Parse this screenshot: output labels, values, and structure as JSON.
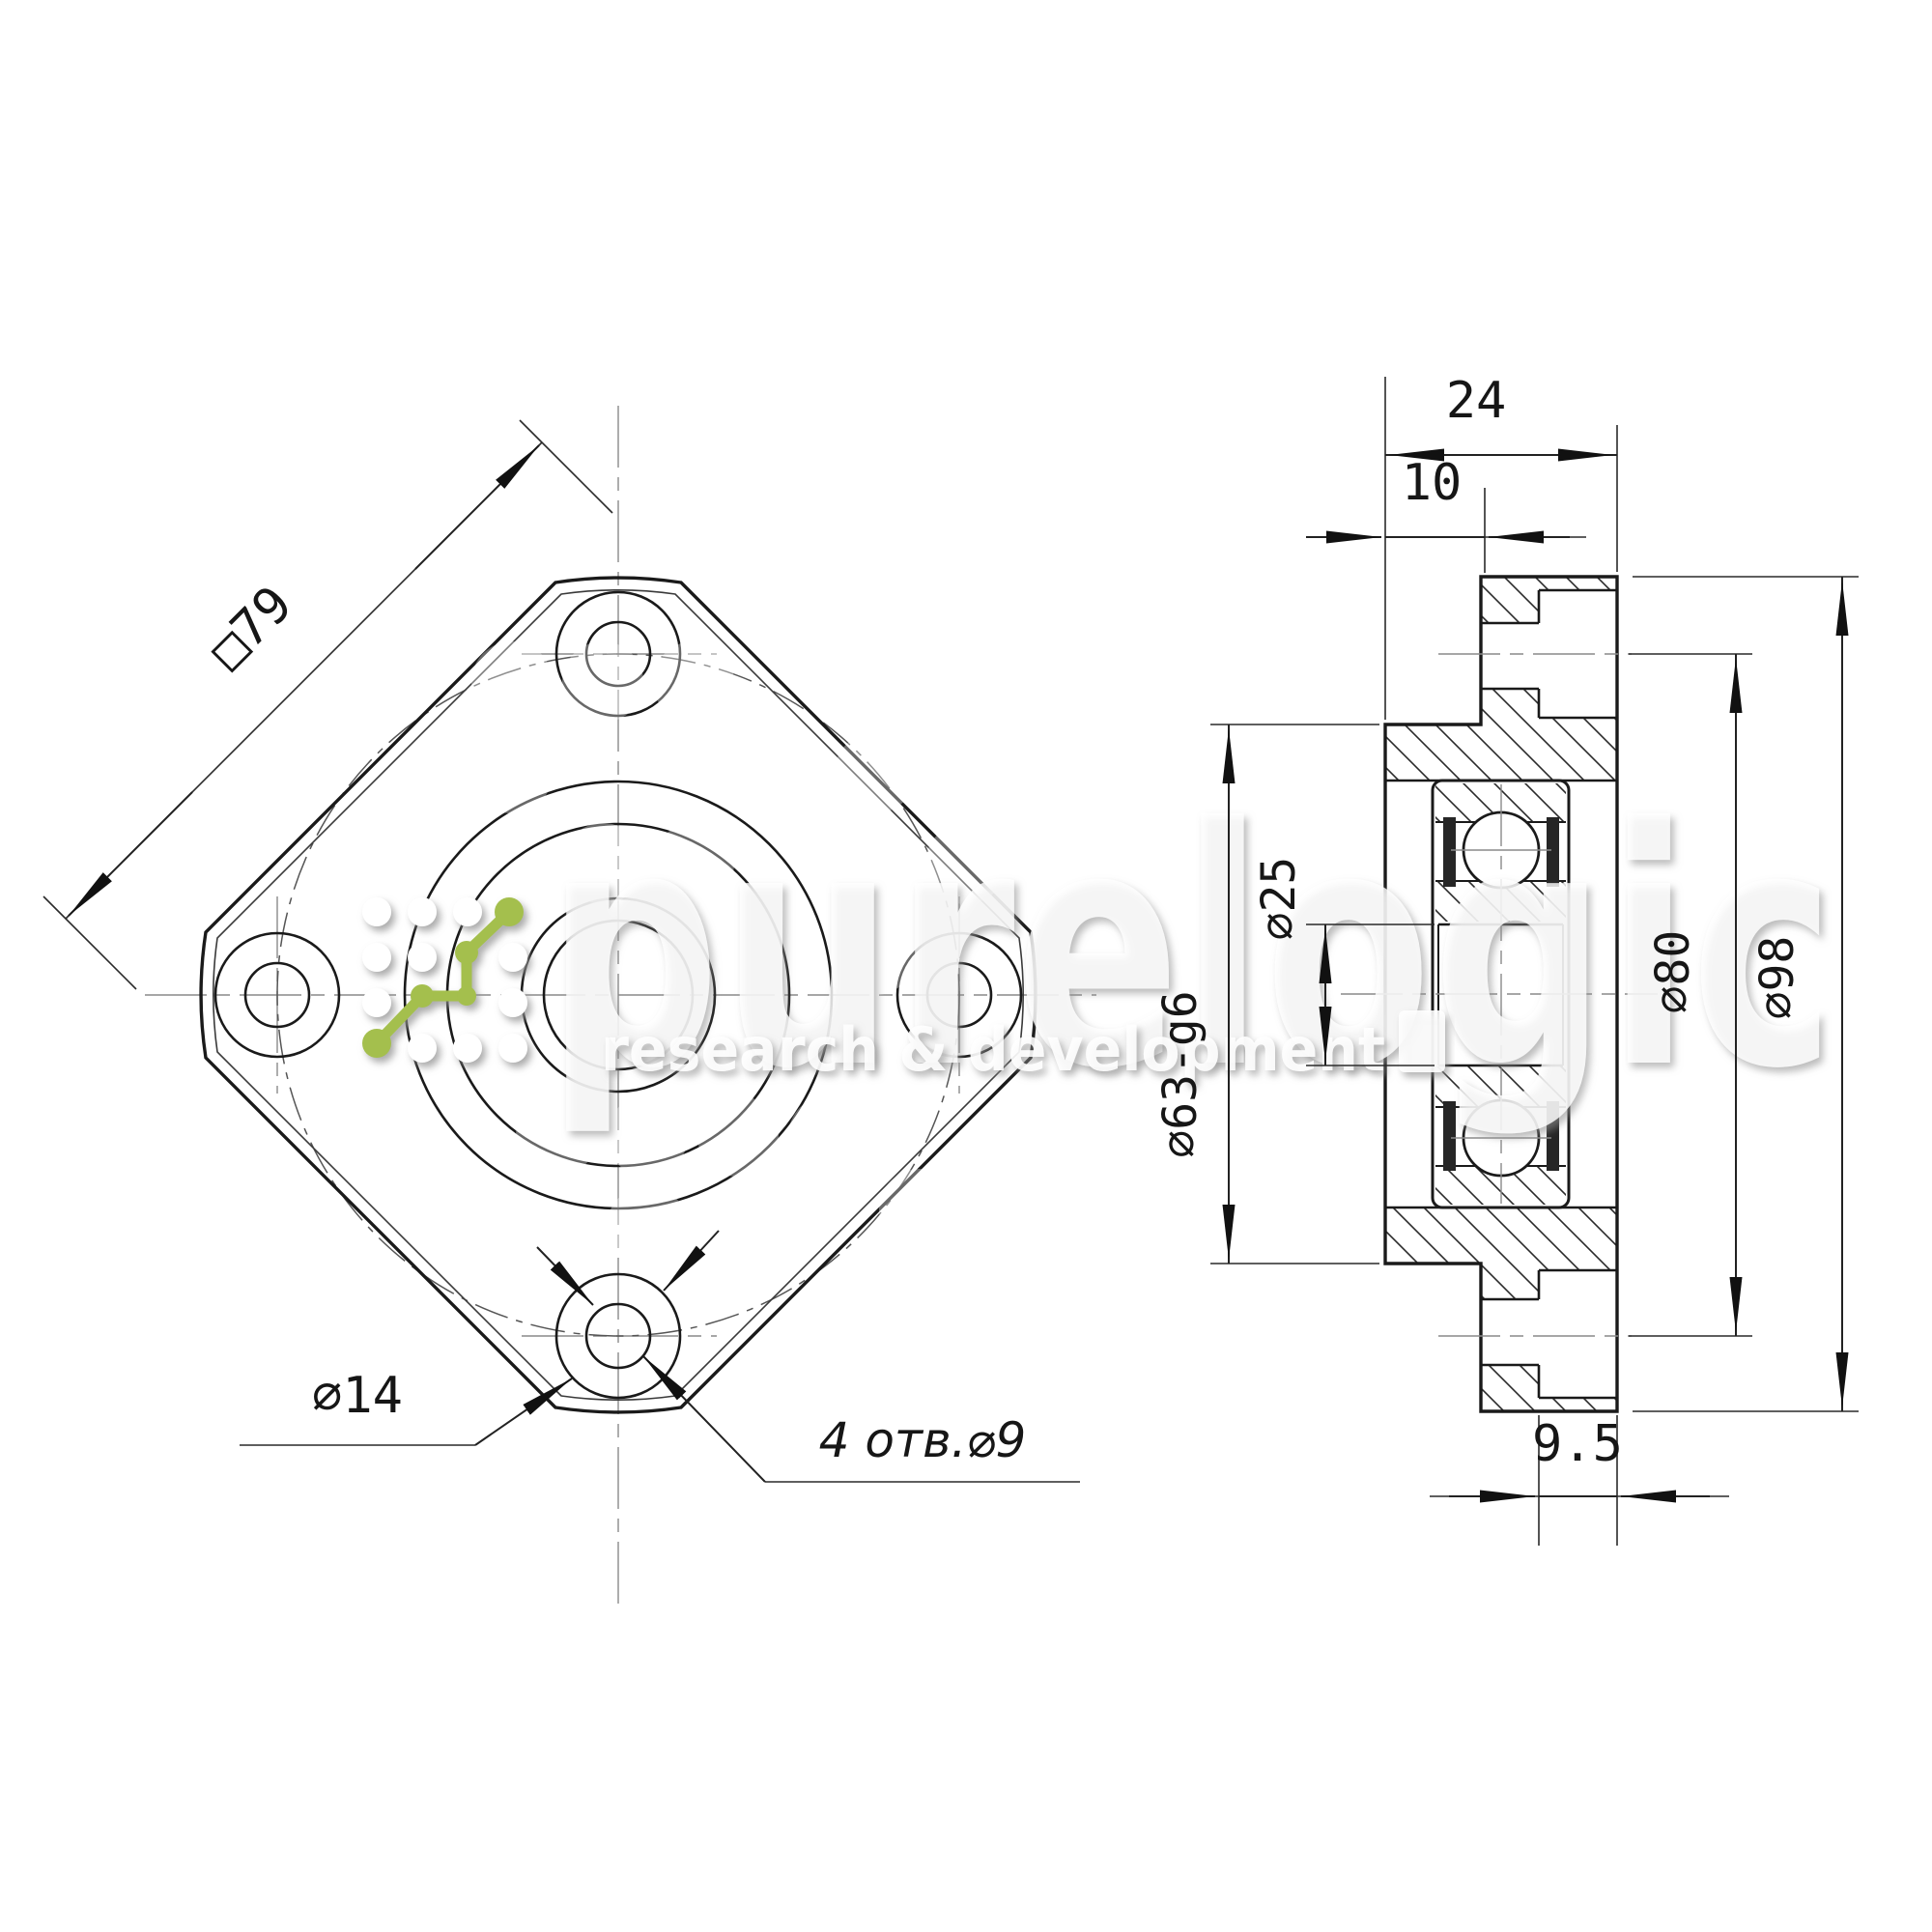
{
  "drawing": {
    "kind": "ballscrew-support-flange-technical-drawing",
    "brand": {
      "name": "purelogic",
      "tagline": "research & development",
      "accent_color": "#a4bf4d"
    },
    "front_view": {
      "square_side_label": "□79",
      "counterbore_label": "⌀14",
      "holes_label": "4 отв.⌀9"
    },
    "section_view": {
      "width_label": "24",
      "pilot_length_label": "10",
      "bore_label": "⌀25",
      "pilot_dia_label": "⌀63-g6",
      "bolt_circle_label": "⌀80",
      "flange_dia_label": "⌀98",
      "counterbore_depth_label": "9.5"
    }
  }
}
